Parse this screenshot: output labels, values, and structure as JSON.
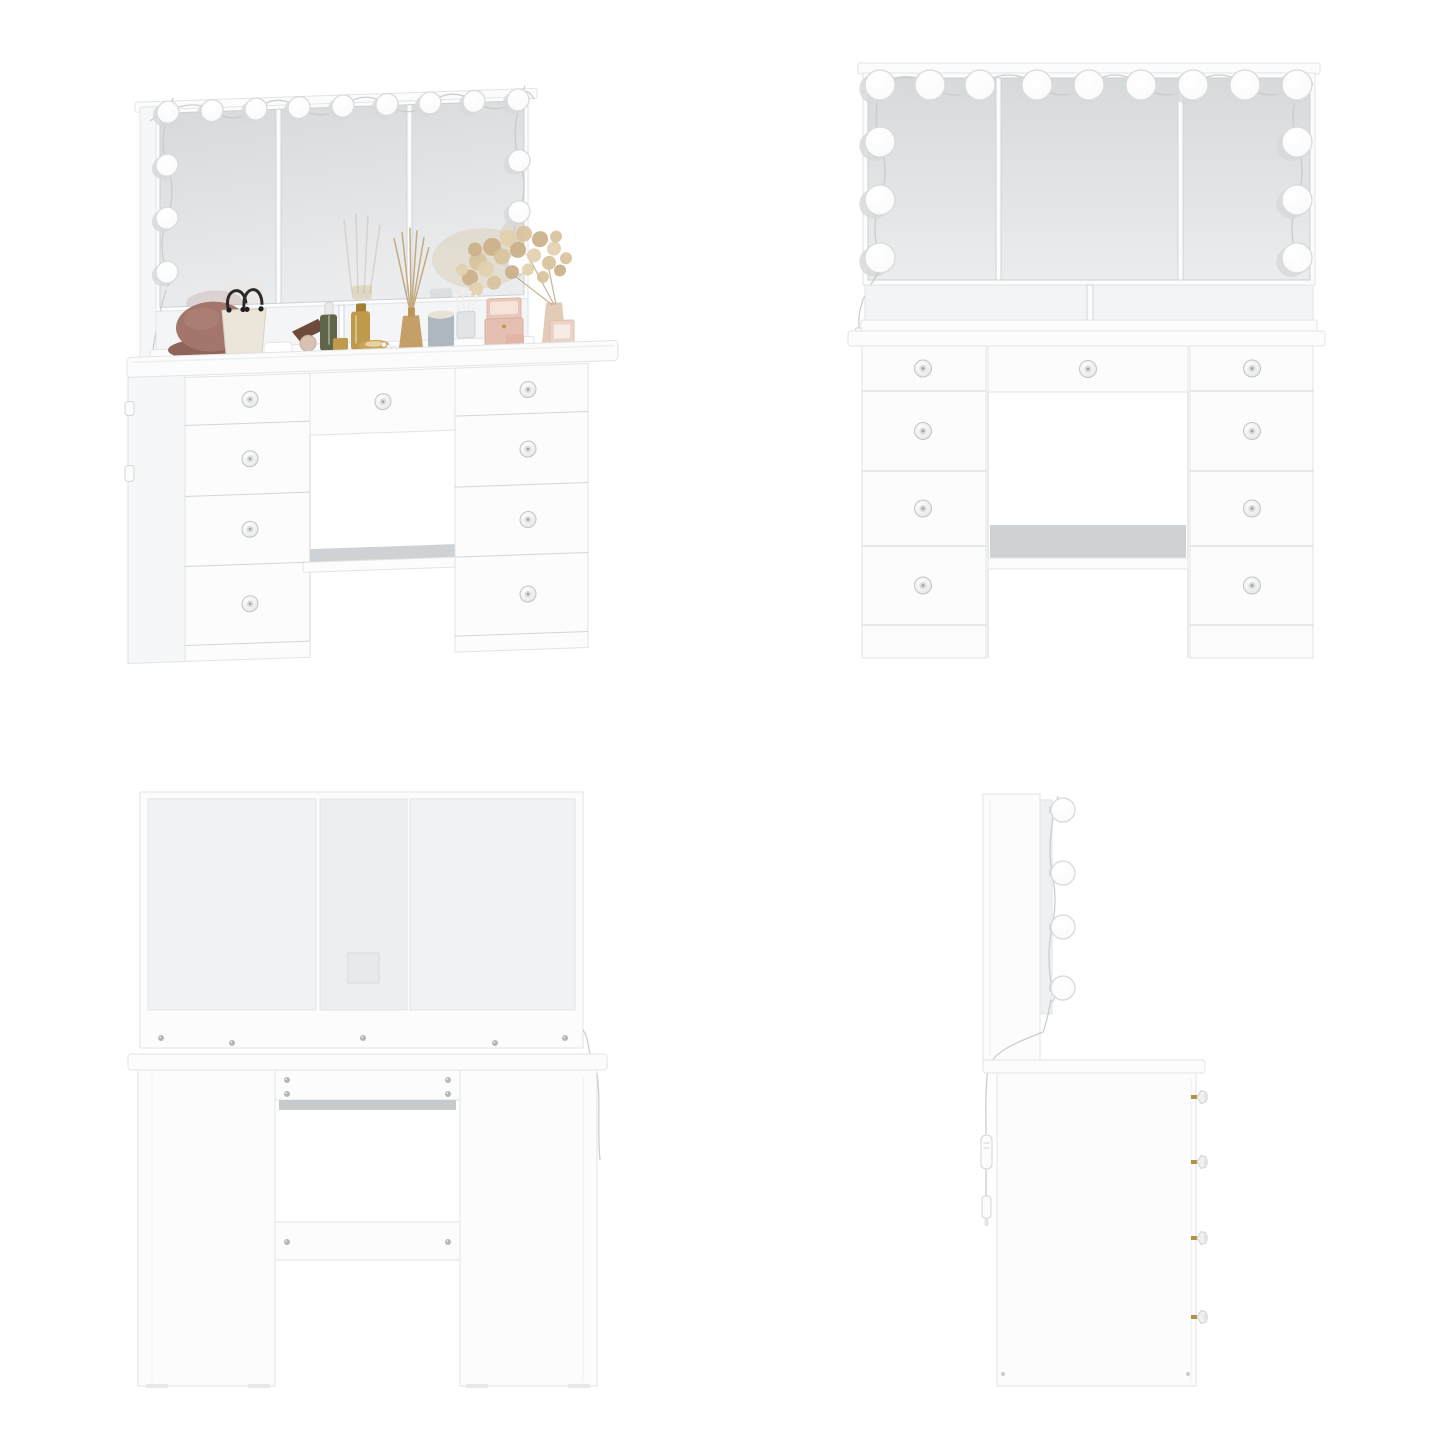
{
  "canvas": {
    "width": 1445,
    "height": 1445,
    "background": "#ffffff"
  },
  "product": {
    "kind": "vanity-dressing-table-with-lighted-trifold-mirror",
    "finish": "white"
  },
  "views": [
    {
      "id": "perspective-view",
      "position": "top-left",
      "bulb_count": 15,
      "bulbs": {
        "top": 9,
        "left_column": 3,
        "right_column": 3
      },
      "drawer_count": 9,
      "drawers": {
        "left_column": 4,
        "center": 1,
        "right_column": 4
      },
      "knob_style": "crystal-silver",
      "props": [
        "cloche-hat",
        "handbag",
        "hand-towel",
        "sandal",
        "powder-compact",
        "serum-bottle",
        "cream-jar",
        "perfume-bottle",
        "hand-mirror",
        "pearl-necklace",
        "reed-diffuser",
        "candle",
        "cotton-swab-cup",
        "jewelry-box",
        "dried-flowers",
        "photo-frame"
      ]
    },
    {
      "id": "front-view",
      "position": "top-right",
      "bulb_count": 15,
      "bulbs": {
        "top": 9,
        "left_column": 3,
        "right_column": 3
      },
      "drawer_count": 9,
      "drawers": {
        "left_column": 4,
        "center": 1,
        "right_column": 4
      },
      "open_shelf_dividers": 1
    },
    {
      "id": "back-view",
      "position": "bottom-left",
      "screws": {
        "upper_rail": 5,
        "apron": 4,
        "stretcher": 2
      },
      "cable_cutout": true
    },
    {
      "id": "side-view",
      "position": "bottom-right",
      "bulb_count": 4,
      "knob_count": 4,
      "features": [
        "power-cord",
        "inline-switch",
        "power-plug"
      ]
    }
  ],
  "palette": {
    "background": "#ffffff",
    "furniture_white": "#fcfcfd",
    "outline": "#e2e4e6",
    "line_strong": "#d2d5d7",
    "mirror_top": "#d7d9db",
    "mirror_bottom": "#eaecee",
    "recess": "#f1f2f4",
    "shelf_gray": "#ced2d5",
    "metal_gray": "#c7cacd",
    "screw": "#b4b7ba",
    "knob_rim": "#c2c4c6",
    "knob_gold": "#b5923f",
    "bulb": "#fefefe",
    "bulb_rim": "#d8dadc",
    "cable": "#c6c9cc",
    "hat_brown": "#a3756b",
    "hat_brim": "#8f6459",
    "bag_cream": "#ece5da",
    "handle_black": "#2b2b2b",
    "serum_olive": "#5f6548",
    "gold": "#bf9a4d",
    "gold_dark": "#a37f33",
    "amber": "#bb8f4d",
    "candle_gray": "#aeb7bd",
    "wax_white": "#e7e3d8",
    "flower_beige_1": "#d8c29c",
    "flower_beige_2": "#cbb089",
    "flower_beige_3": "#e2d0ae",
    "box_pink": "#e8c8ba",
    "box_pink_light": "#f6e4da",
    "frame_pink": "#ecd3c6",
    "vase_tan": "#e0c9b4"
  }
}
